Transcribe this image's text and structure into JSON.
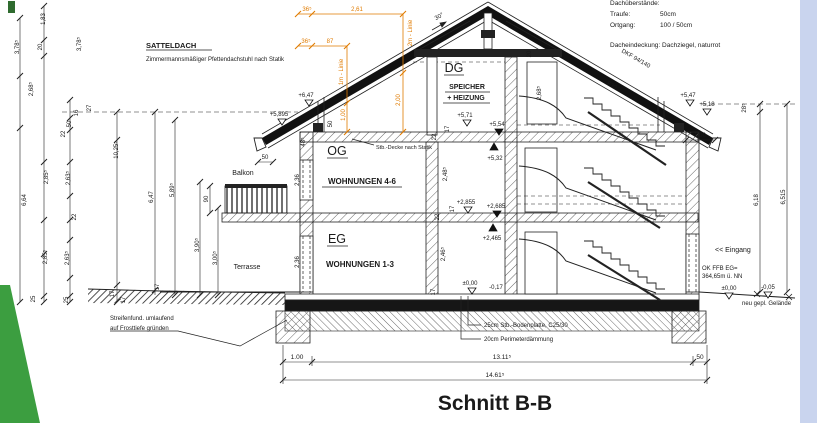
{
  "title": "Schnitt B-B",
  "colors": {
    "paper": "#ffffff",
    "side_strip": "#c9d4ee",
    "accent_green": "#3c9e40",
    "dim_orange": "#e07b00",
    "ink": "#1a1a1a"
  },
  "labels": {
    "satteldach": "SATTELDACH",
    "satteldach_note": "Zimmermannsmäßiger Pfettendachstuhl nach Statik",
    "pitch": "30°",
    "dkf": "DKF 94/140",
    "f30": "F30",
    "dg": "DG",
    "speicher": "SPEICHER",
    "heizung": "+ HEIZUNG",
    "og": "OG",
    "wohnungen_og": "WOHNUNGEN 4-6",
    "eg": "EG",
    "wohnungen_eg": "WOHNUNGEN 1-3",
    "balkon": "Balkon",
    "terrasse": "Terrasse",
    "eingang": "<< Eingang",
    "ok_ffb": "OK FFB EG=",
    "ok_ffb2": "364,65m ü. NN",
    "gelaende": "neu gepl. Gelände",
    "decke_note": "Stb.-Decke nach Statik",
    "fundament1": "Streifenfund. umlaufend",
    "fundament2": "auf Frosttiefe gründen",
    "bodenplatte": "25cm Stb.-Bodenplatte, C25/30",
    "daemmung": "20cm Perimeterdämmung",
    "m1": "1m - Linie",
    "m2": "2m - Linie"
  },
  "roof_info": {
    "header": "Dachüberstände:",
    "traufe": "Traufe:",
    "traufe_v": "50cm",
    "ortgang": "Ortgang:",
    "ortgang_v": "100 / 50cm",
    "deckung": "Dacheindeckung: Dachziegel, naturrot"
  },
  "levels": {
    "l647": "+6,47",
    "l5895": "+5,895",
    "l571": "+5,71",
    "l554": "+5,54",
    "l532": "+5,32",
    "l547": "+5,47",
    "l518": "+5,18",
    "l2855": "+2,855",
    "l2685": "+2,685",
    "l2465": "+2,465",
    "l000": "±0,00",
    "l017": "-0,17",
    "l000r": "±0,00",
    "l005": "-0,05"
  },
  "dims": {
    "d183": "1,83",
    "d378a": "3,78⁵",
    "d20": "20",
    "d378b": "3,78⁵",
    "d268": "2,68⁵",
    "d27": "27",
    "d16": "16",
    "d50a": "50",
    "d22a": "22",
    "d1025": "10,25⁵",
    "d664": "6,64",
    "d285a": "2,85⁵",
    "d263a": "2,63⁵",
    "d22b": "22",
    "d285b": "2,85⁵",
    "d263b": "2,63⁵",
    "d25a": "25",
    "d25b": "25",
    "d17a": "17",
    "d17b": "17",
    "d647": "6,47",
    "d589": "5,89⁵",
    "d390": "3,90⁵",
    "d300": "3,00⁵",
    "d90": "90",
    "d50b": "50",
    "d17c": "17",
    "d236a": "2,36",
    "d248": "2,48⁵",
    "d236b": "2,36",
    "d246": "2,46⁵",
    "d268dg": "2,68⁵",
    "d20dg": "20",
    "d50c": "50",
    "d485": "48⁵",
    "d22c": "22",
    "d17d": "17",
    "d22d": "22",
    "d17e": "17",
    "d17f": "17",
    "d285r": "28⁵",
    "d618": "6,18",
    "d6515": "6,515",
    "d100r": "1,00",
    "o36a": "36⁵",
    "o261": "2,61",
    "o36b": "36⁵",
    "o87": "87",
    "o100": "1,00",
    "o200": "2,00",
    "b100": "1.00",
    "b1311": "13.11⁵",
    "b50": "50",
    "b1461": "14.61⁵"
  }
}
